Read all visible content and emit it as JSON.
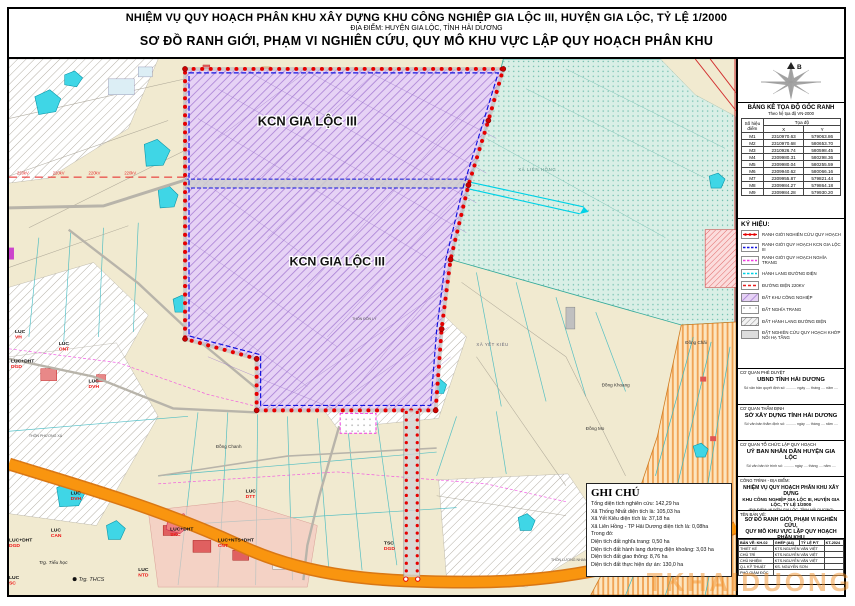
{
  "title_block": {
    "line1": "NHIỆM VỤ QUY HOẠCH PHÂN KHU XÂY DỰNG KHU CÔNG NGHIỆP GIA LỘC III, HUYỆN GIA LỘC, TỶ LỆ 1/2000",
    "line2": "ĐỊA ĐIỂM: HUYỆN GIA LỘC, TỈNH HẢI DƯƠNG",
    "line3": "SƠ ĐỒ RANH GIỚI, PHẠM VI NGHIÊN CỨU, QUY MÔ KHU VỰC LẬP QUY HOẠCH PHÂN KHU"
  },
  "compass": {
    "north_label": "B"
  },
  "coordinate_table": {
    "title": "BẢNG KÊ TỌA ĐỘ GỐC RANH",
    "subtitle": "Theo hệ tọa độ VN-2000",
    "col_point": "Số hiệu điểm",
    "col_coord": "Tọa độ",
    "col_x": "X",
    "col_y": "Y",
    "rows": [
      {
        "id": "M1",
        "x": "2310970.63",
        "y": "579063.86"
      },
      {
        "id": "M2",
        "x": "2310970.68",
        "y": "580653.70"
      },
      {
        "id": "M3",
        "x": "2310926.74",
        "y": "580598.45"
      },
      {
        "id": "M4",
        "x": "2309980.31",
        "y": "580298.36"
      },
      {
        "id": "M5",
        "x": "2309980.04",
        "y": "580255.59"
      },
      {
        "id": "M6",
        "x": "2309940.62",
        "y": "580066.16"
      },
      {
        "id": "M7",
        "x": "2309955.87",
        "y": "579821.44"
      },
      {
        "id": "M8",
        "x": "2309984.27",
        "y": "579864.18"
      },
      {
        "id": "M9",
        "x": "2309984.28",
        "y": "579930.20"
      }
    ]
  },
  "legend": {
    "title": "KÝ HIỆU:",
    "items": [
      {
        "label": "RANH GIỚI NGHIÊN CỨU QUY HOẠCH"
      },
      {
        "label": "RANH GIỚI QUY HOẠCH KCN GIA LỘC III"
      },
      {
        "label": "RANH GIỚI QUY HOẠCH NGHĨA TRANG"
      },
      {
        "label": "HÀNH LANG ĐƯỜNG ĐIỆN"
      },
      {
        "label": "ĐƯỜNG ĐIỆN 220KV"
      },
      {
        "label": "ĐẤT KHU CÔNG NGHIỆP"
      },
      {
        "label": "ĐẤT NGHĨA TRANG"
      },
      {
        "label": "ĐẤT HÀNH LANG ĐƯỜNG ĐIỆN"
      },
      {
        "label": "ĐẤT NGHIÊN CỨU QUY HOẠCH KHỚP NỐI HẠ TẦNG"
      }
    ]
  },
  "approvals": [
    {
      "role": "CƠ QUAN PHÊ DUYỆT",
      "name": "UBND TỈNH HẢI DƯƠNG",
      "note": "Số văn bản quyết định số: .......... ngày .... tháng .... năm ...."
    },
    {
      "role": "CƠ QUAN THẨM ĐỊNH",
      "name": "SỞ XÂY DỰNG TỈNH HẢI DƯƠNG",
      "note": "Số văn bản thẩm định số: .......... ngày .... tháng .... năm ...."
    },
    {
      "role": "CƠ QUAN TỔ CHỨC LẬP QUY HOẠCH",
      "name": "UỶ BAN NHÂN DÂN HUYỆN GIA LỘC",
      "note": "Số văn bản tờ trình số: .......... ngày .... tháng .... năm ...."
    }
  ],
  "project_block": {
    "label": "CÔNG TRÌNH - ĐỊA ĐIỂM:",
    "line1": "NHIỆM VỤ QUY HOẠCH PHÂN KHU XÂY DỰNG",
    "line2": "KHU CÔNG NGHIỆP GIA LỘC III, HUYỆN GIA LỘC, TỶ LỆ 1/2000",
    "line3": "(ĐỊA ĐIỂM: HUYỆN GIA LỘC, TỈNH HẢI DƯƠNG)"
  },
  "drawing_block": {
    "label": "TÊN BẢN VẼ:",
    "line1": "SƠ ĐỒ RANH GIỚI, PHẠM VI NGHIÊN CỨU,",
    "line2": "QUY MÔ KHU VỰC LẬP QUY HOẠCH PHÂN KHU",
    "table": {
      "header": [
        "BẢN VẼ: KH-02",
        "GHÉP (A4)",
        "TỶ LỆ P/T",
        "KT-2024"
      ],
      "rows": [
        [
          "THIẾT KẾ",
          "KTS.NGUYỄN VĂN VIỆT"
        ],
        [
          "CHỦ TRÌ",
          "KTS.NGUYỄN VĂN VIỆT"
        ],
        [
          "CHỦ NHIỆM",
          "KTS.NGUYỄN VĂN VIỆT"
        ],
        [
          "Q.L KỸ THUẬT",
          "KS. NGUYỄN SƠN"
        ],
        [
          "PHÓ GIÁM ĐỐC",
          ""
        ]
      ]
    }
  },
  "notes": {
    "title": "GHI CHÚ",
    "lines": [
      "Tổng diện tích nghiên cứu: 142,29 ha",
      "Xã Thống Nhất diện tích là: 105,03 ha",
      "Xã Yết Kiêu diện tích là: 37,18 ha",
      "Xã Liên Hồng - TP Hải Dương diện tích là: 0,08ha",
      "Trong đó:",
      "Diện tích đất nghĩa trang: 0,50 ha",
      "Diện tích đất hành lang đường điện khoảng: 3,03 ha",
      "Diện tích đất giao thông: 8,76 ha",
      "Diện tích đất thực hiện dự án: 130,0 ha"
    ]
  },
  "map": {
    "kcn_label_top": "KCN GIA LỘC III",
    "kcn_label_bottom": "KCN GIA LỘC III",
    "power_label": "220kV",
    "commune_lien_hong": "XÃ LIÊN HỒNG",
    "commune_yet_kieu": "XÃ YẾT KIÊU",
    "village_don_ly": "THÔN ĐÔN LÝ",
    "village_phuong_xa": "THÔN PHƯƠNG XÁ",
    "village_luong_nhan": "THÔN LƯƠNG NHAN",
    "places": {
      "dong_chanh": "Đồng Chanh",
      "dong_khoang": "Đồng Khoang",
      "dong_mo": "Đồng Mo",
      "dong_chai": "Đồng Chãi"
    },
    "schools": {
      "tieu_hoc": "Trg. Tiểu học",
      "thcs": "Trg. THCS"
    },
    "parcels": [
      {
        "code": "LUC",
        "zone": "VH"
      },
      {
        "code": "LUC",
        "zone": "ONT"
      },
      {
        "code": "LUC+DHT",
        "zone": "DGD"
      },
      {
        "code": "LUC",
        "zone": "DVH"
      },
      {
        "code": "LUC",
        "zone": "DVH"
      },
      {
        "code": "LUC",
        "zone": "CAN"
      },
      {
        "code": "LUC+DHT",
        "zone": "DGD"
      },
      {
        "code": "LUC",
        "zone": "NTD"
      },
      {
        "code": "LUC+DHT",
        "zone": "SKC"
      },
      {
        "code": "LUC+NTS+DHT",
        "zone": "CNT"
      },
      {
        "code": "LUC",
        "zone": "DTT"
      },
      {
        "code": "TSC",
        "zone": "DGD"
      },
      {
        "code": "NTD",
        "zone": "DVH"
      },
      {
        "code": "LUC",
        "zone": "SC"
      }
    ]
  },
  "watermark": "TKHAIDUONG",
  "colors": {
    "boundary_red": "#e60000",
    "kcn_boundary_blue": "#1414dd",
    "cemetery_magenta": "#f23ae2",
    "corridor_cyan": "#00d2e6",
    "kcn_purple": "#a87fd4",
    "highway_orange": "#ef8812"
  }
}
